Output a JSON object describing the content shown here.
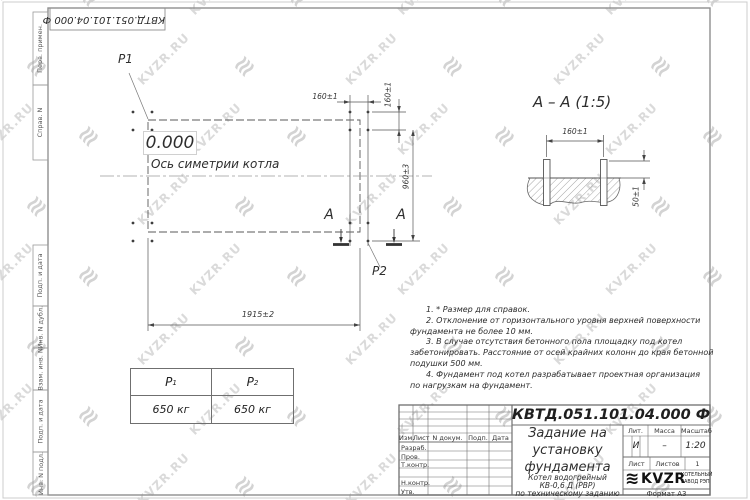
{
  "watermark": {
    "text": "KVZR.RU",
    "icon_glyph": "≋"
  },
  "corner_stamp": {
    "doc_number_inverted": "КВТД.051.101.04.000 Ф"
  },
  "margin_labels": {
    "perv_primen": "Перв. примен.",
    "sprav_n": "Справ. N",
    "podp_data_1": "Подп. и дата",
    "inv_dubl": "Инв. N дубл.",
    "vzam_inv": "Взам. инв. N",
    "podp_data_2": "Подп. и дата",
    "inv_podl": "Инв. N подл."
  },
  "plan": {
    "p1_label": "P1",
    "p2_label": "P2",
    "elevation": "0.000",
    "axis_label": "Ось симетрии котла",
    "dim_160_top": "160±1",
    "dim_160_side": "160±1",
    "dim_960": "960±3",
    "dim_1915": "1915±2",
    "section_letter": "А"
  },
  "section_view": {
    "title": "А – А (1:5)",
    "dim_160": "160±1",
    "dim_50": "50±1"
  },
  "notes": {
    "lines": [
      "1. * Размер для справок.",
      "2. Отклонение от горизонтального уровня верхней поверхности",
      "фундамента не более 10 мм.",
      "3. В случае отсутствия бетонного пола площадку под котел",
      "забетонировать. Расстояние от осей крайних колонн до края бетонной",
      "подушки 500 мм.",
      "4. Фундамент под котел разрабатывает проектная организация",
      "по нагрузкам на фундамент."
    ]
  },
  "load_table": {
    "headers": [
      {
        "base": "P",
        "sub": "1"
      },
      {
        "base": "P",
        "sub": "2"
      }
    ],
    "values": [
      "650 кг",
      "650 кг"
    ]
  },
  "title_block": {
    "doc_number": "КВТД.051.101.04.000 Ф",
    "title_line1": "Задание на",
    "title_line2": "установку",
    "title_line3": "фундамента",
    "product_line1": "Котел водогрейный",
    "product_line2": "КВ-0,6 Д (РВР)",
    "product_line3": "по техническому заданию",
    "col_izm": "Изм.",
    "col_list": "Лист",
    "col_doc": "N докум.",
    "col_podp": "Подп.",
    "col_data": "Дата",
    "role_razrab": "Разраб.",
    "role_prov": "Пров.",
    "role_tkontr": "Т.контр.",
    "role_nkontr": "Н.контр.",
    "role_utv": "Утв.",
    "lit_label": "Лит.",
    "mass_label": "Масса",
    "scale_label": "Масштаб",
    "lit_value": "И",
    "mass_value": "–",
    "scale_value": "1:20",
    "sheet_label": "Лист",
    "sheets_label": "Листов",
    "sheets_value": "1",
    "logo_text": "KVZR",
    "logo_icon_glyph": "≋",
    "logo_sub1": "КОТЕЛЬНЫЙ",
    "logo_sub2": "ЗАВОД РЭП",
    "format_label": "Формат А3"
  }
}
